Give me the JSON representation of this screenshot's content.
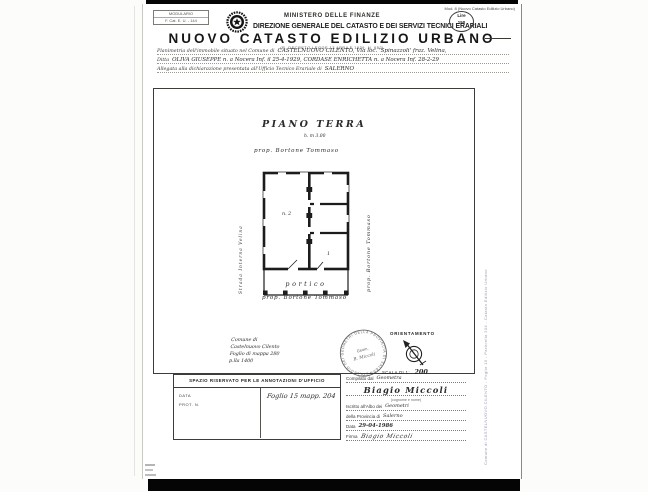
{
  "doc": {
    "modulario": {
      "line1": "MODULARIO",
      "line2": "F. Cat. E. U. - 144"
    },
    "header": {
      "ministry": "MINISTERO DELLE FINANZE",
      "direction": "DIREZIONE GENERALE DEL CATASTO E DEI SERVIZI TECNICI ERARIALI",
      "title": "NUOVO CATASTO EDILIZIO URBANO",
      "subtitle": "(R. DECRETO-LEGGE 13 APRILE 1939, N. 652)",
      "mod_ref": "Mod. 8 (Nuovo Catasto Edilizio Urbano)",
      "lire_line1": "Lire",
      "lire_line2": "150"
    },
    "declaration": {
      "line1_print": "Planimetria dell'immobile situato nel Comune di",
      "line1_hand": "CASTELNUOVO CILENTO, Via loc. 'Spinazzoli' fraz. Velina,",
      "line2_print": "Ditta",
      "line2_hand": "OLIVA GIUSEPPE n. a Nocera Inf. il 25-4-1929, CORDASE ENRICHETTA n. a Nocera Inf. 28-2-29",
      "line3_print": "Allegata alla dichiarazione presentata all'Ufficio Tecnico Erariale di",
      "line3_hand": "SALERNO"
    },
    "drawing": {
      "floor_label": "PIANO TERRA",
      "height_note": "h. m 3.00",
      "prop_top": "prop. Bortone Tommaso",
      "prop_right": "prop. Bortone Tommaso",
      "prop_bottom": "prop. Bortone Tommaso",
      "street_left": "Strada Interna Velina",
      "room_label": "n. 2",
      "small_room_label": "1",
      "portico_label": "portico",
      "map_note": {
        "line1": "Comune di",
        "line2": "Castelnuovo Cilento",
        "line3": "Foglio di mappa 280",
        "line4": "p.lla 1400"
      },
      "stamp_ring": "COLLEGIO DEI GEOMETRI DELLA PROVINCIA DI SALERNO",
      "stamp_center1": "Geom.",
      "stamp_center2": "B. Miccoli",
      "orientation_label": "ORIENTAMENTO",
      "scale_print": "SCALA DI 1:",
      "scale_hand": "200"
    },
    "office_box": {
      "header": "SPAZIO RISERVATO PER LE ANNOTAZIONI D'UFFICIO",
      "data_label": "DATA",
      "prot_label": "PROT. N.",
      "note_hand": "Foglio 15 mapp. 204"
    },
    "signature": {
      "compiled_print": "Compilato dal",
      "compiled_hand": "Geometra",
      "name_hand": "Biagio Miccoli",
      "name_caption": "(cognome e nome)",
      "register_print": "Iscritto all'Albo dei",
      "register_hand": "Geometri",
      "province_print": "della Provincia di",
      "province_hand": "Salerno",
      "date_print": "Data",
      "date_hand": "29-04-1986",
      "sign_print": "Firma",
      "sign_hand": "Biagio Miccoli"
    },
    "margins": {
      "right_watermark": "Comune di CASTELNUOVO CILENTO - Foglio 15 - Particella 204 - Catasto Edilizio Urbano"
    }
  }
}
